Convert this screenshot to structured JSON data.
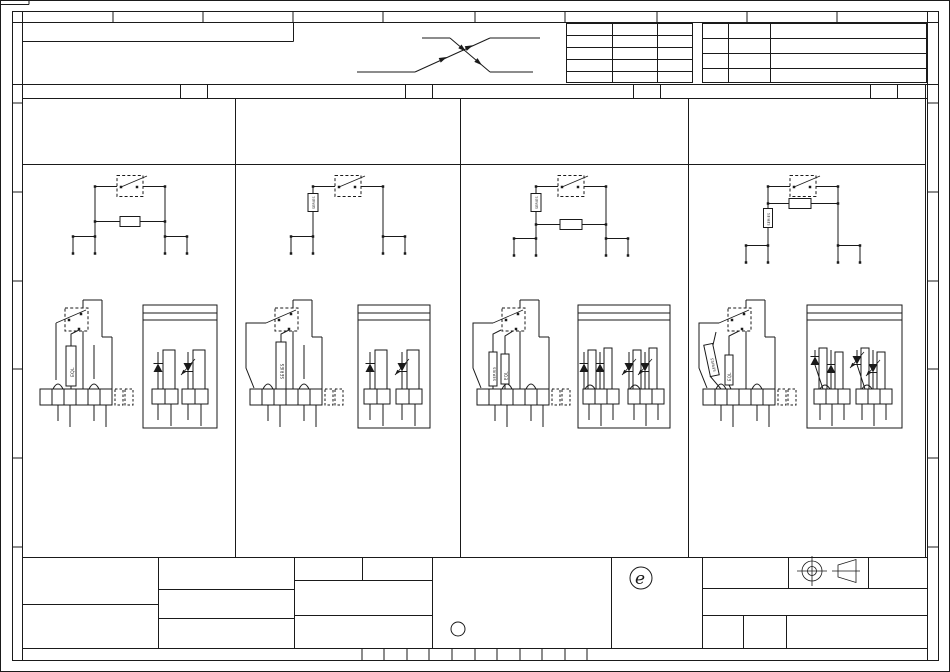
{
  "sheet": {
    "background_color": "#ffffff",
    "line_color": "#1a1a1a",
    "stamp_letter": "e"
  },
  "labels": {
    "eql": "EQL",
    "series": "SERIES"
  },
  "columns": [
    {
      "top_circuit_resistor_labels": [],
      "mid_circuit_resistor_labels": [
        "EQL"
      ]
    },
    {
      "top_circuit_resistor_labels": [
        "SERIES"
      ],
      "mid_circuit_resistor_labels": [
        "SERIES"
      ]
    },
    {
      "top_circuit_resistor_labels": [
        "SERIES"
      ],
      "mid_circuit_resistor_labels": [
        "SERIES",
        "EQL"
      ]
    },
    {
      "top_circuit_resistor_labels": [
        "SERIES"
      ],
      "mid_circuit_resistor_labels": [
        "SERIES",
        "EQL"
      ]
    }
  ]
}
